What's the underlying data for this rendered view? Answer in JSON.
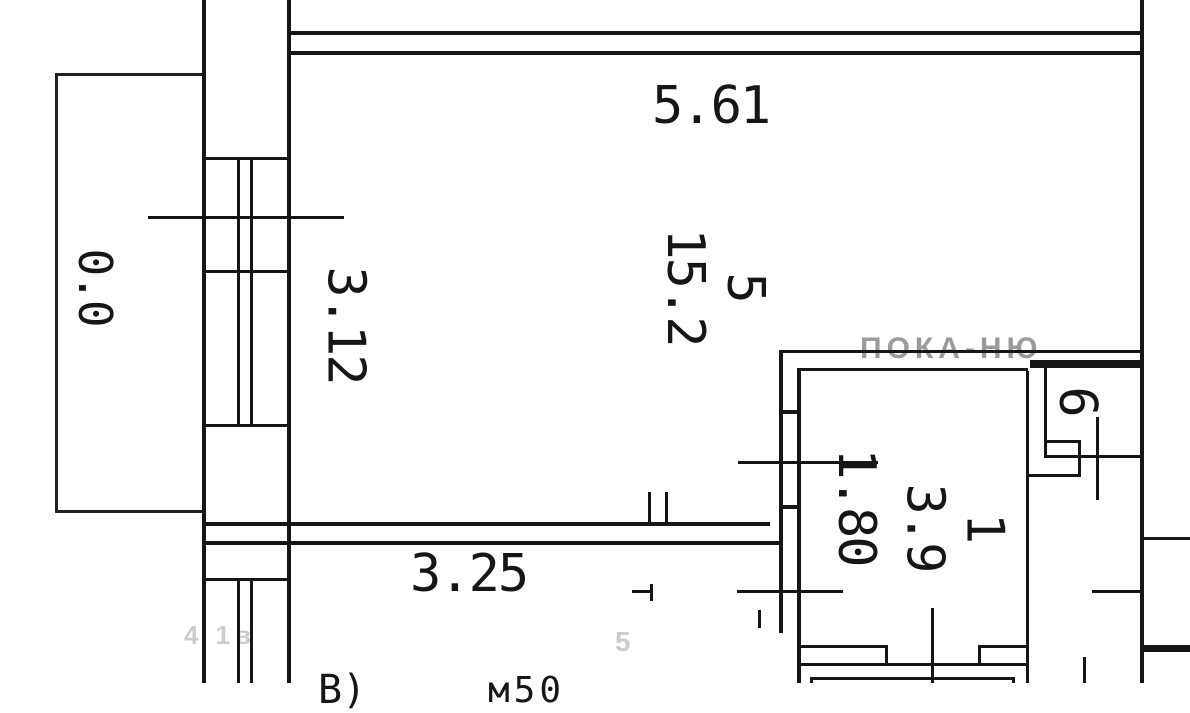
{
  "plan": {
    "dimensions": {
      "top_width": "5.61",
      "left_wall": "3.12",
      "bottom_width": "3.25",
      "bath_width": "1.80"
    },
    "rooms": {
      "living": {
        "number": "5",
        "area": "15.2"
      },
      "bath": {
        "number": "1",
        "area": "3.9"
      },
      "closet": {
        "number": "6"
      },
      "balcony": {
        "area": "0.0"
      }
    },
    "edge_fragments": {
      "left": "В)",
      "right": "м50"
    },
    "watermarks": {
      "top": "ПОКА-НЮ",
      "bottom_left": "4 1в",
      "bottom_mid": "5"
    },
    "colors": {
      "line": "#161616",
      "watermark": "#9b9b9b",
      "background": "#ffffff"
    }
  }
}
